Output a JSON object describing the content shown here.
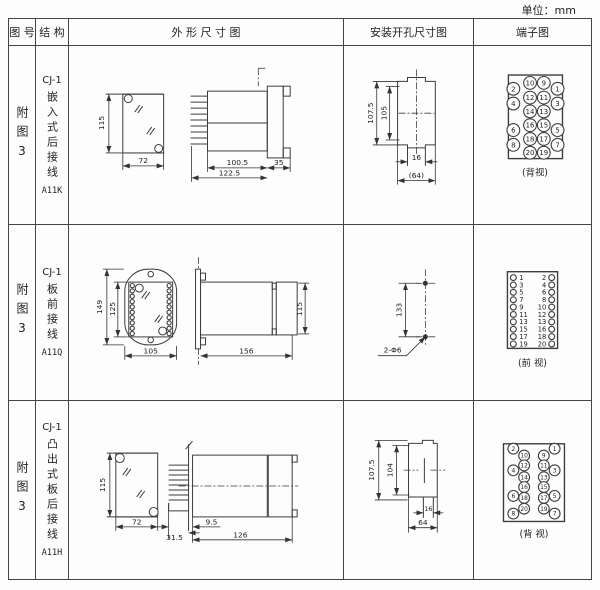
{
  "unit_label": "单位：mm",
  "headers": [
    "图 号",
    "结 构",
    "外 形 尺 寸 图",
    "安装开孔尺寸图",
    "端子图"
  ],
  "rows": [
    {
      "fig_no": "附图3",
      "series": "CJ-1",
      "name": "嵌入式后接线",
      "code": "A11K",
      "outline": {
        "h": "115",
        "w": "72",
        "body": "100.5",
        "total": "122.5",
        "flange": "35"
      },
      "mounting": {
        "outer": "107.5",
        "inner": "105",
        "slot": "16",
        "width": "(64)"
      },
      "terminal": {
        "view": "(背视)",
        "inner": [
          [
            "10",
            "9"
          ],
          [
            "12",
            "11"
          ],
          [
            "14",
            "13"
          ],
          [
            "16",
            "15"
          ],
          [
            "18",
            "17"
          ],
          [
            "20",
            "19"
          ]
        ],
        "outer": [
          [
            "2",
            "1"
          ],
          [
            "4",
            "3"
          ],
          [
            "6",
            "5"
          ],
          [
            "8",
            "7"
          ]
        ]
      }
    },
    {
      "fig_no": "附图3",
      "series": "CJ-1",
      "name": "板前接线",
      "code": "A11Q",
      "outline": {
        "outer_h": "149",
        "inner_h": "125",
        "w": "105",
        "len": "156",
        "side_h": "115"
      },
      "mounting": {
        "pitch": "133",
        "holes": "2-Φ6"
      },
      "terminal": {
        "view": "(前 视)",
        "left": [
          "1",
          "3",
          "5",
          "7",
          "9",
          "11",
          "13",
          "15",
          "17",
          "19"
        ],
        "right": [
          "2",
          "4",
          "6",
          "8",
          "10",
          "12",
          "13",
          "16",
          "18",
          "20"
        ]
      }
    },
    {
      "fig_no": "附图3",
      "series": "CJ-1",
      "name": "凸出式板后接线",
      "code": "A11H",
      "outline": {
        "h": "115",
        "w": "72",
        "pins": "31.5",
        "offset": "9.5",
        "len": "126"
      },
      "mounting": {
        "outer": "107.5",
        "inner": "104",
        "slot": "16",
        "width": "64"
      },
      "terminal": {
        "view": "(背 视)",
        "outer_left": [
          "2",
          "4",
          "6",
          "8"
        ],
        "inner_left": [
          "10",
          "12",
          "14",
          "16",
          "18",
          "20"
        ],
        "inner_right": [
          "9",
          "11",
          "13",
          "15",
          "17",
          "19"
        ],
        "outer_right": [
          "1",
          "3",
          "5",
          "7"
        ]
      }
    }
  ]
}
